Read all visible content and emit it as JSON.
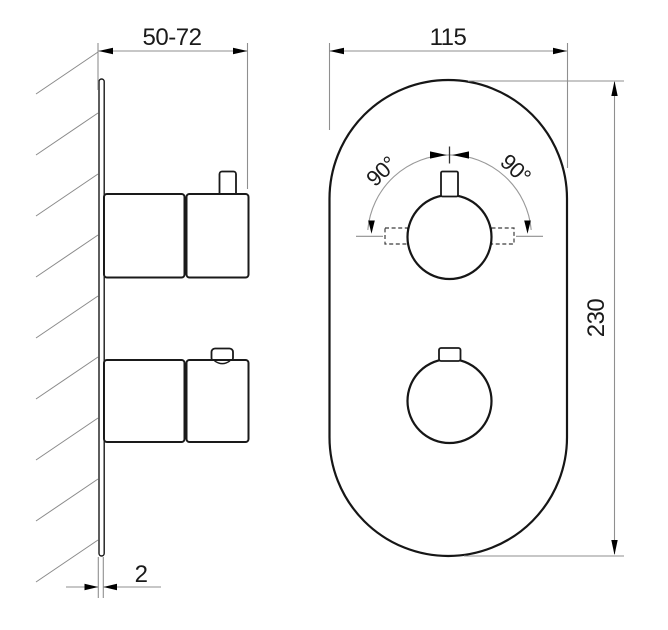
{
  "drawing": {
    "side_view": {
      "depth_dimension": "50-72",
      "plate_thickness_dimension": "2"
    },
    "front_view": {
      "width_dimension": "115",
      "height_dimension": "230",
      "rotation_angle_left": "90°",
      "rotation_angle_right": "90°"
    },
    "colors": {
      "background": "#ffffff",
      "outline": "#161616",
      "dimension_line": "#8f8f8f",
      "arrowhead": "#000000",
      "text": "#1a1a1a"
    }
  }
}
